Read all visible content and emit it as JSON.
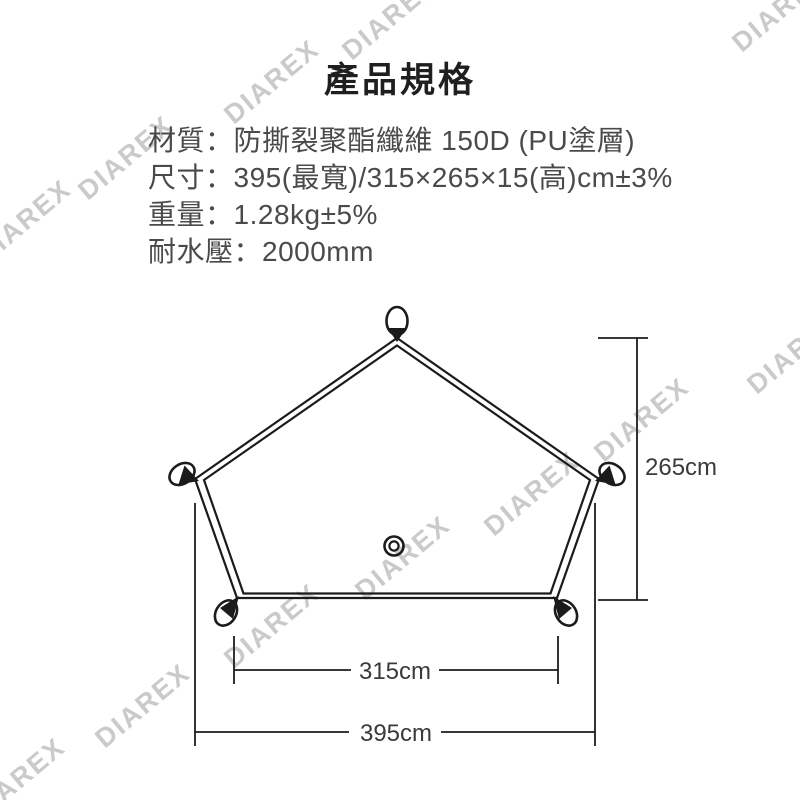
{
  "title": "產品規格",
  "specs": [
    {
      "label": "材質：",
      "value": "防撕裂聚酯纖維 150D (PU塗層)"
    },
    {
      "label": "尺寸：",
      "value": "395(最寬)/315×265×15(高)cm±3%"
    },
    {
      "label": "重量：",
      "value": "1.28kg±5%"
    },
    {
      "label": "耐水壓：",
      "value": "2000mm"
    }
  ],
  "diagram": {
    "shape": "pentagon tarp footprint, five corner loops, center grommet",
    "height_label": "265cm",
    "bottom_width_label": "315cm",
    "max_width_label": "395cm"
  },
  "watermark": {
    "text": "DIAREX"
  },
  "colors": {
    "background": "#ffffff",
    "line": "#1b1b1b",
    "title_text": "#1f1f1f",
    "spec_text": "#4a4a4a",
    "dim_text": "#3a3a3a",
    "watermark": "#cacaca"
  }
}
